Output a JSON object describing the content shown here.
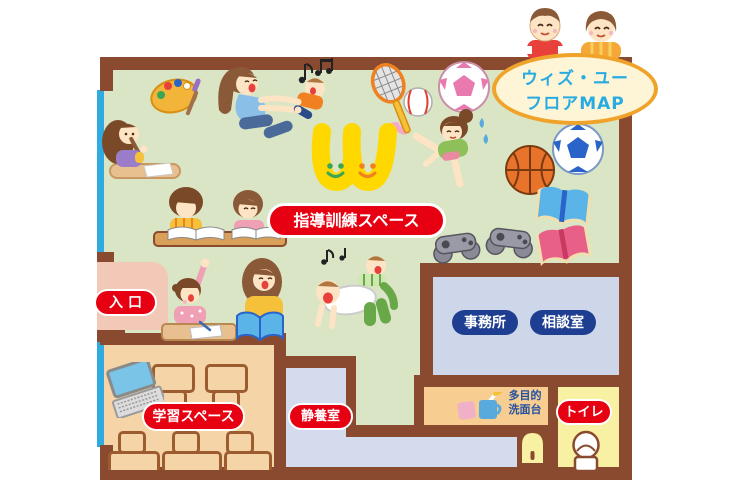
{
  "title_bubble": {
    "line1": "ウィズ・ユー",
    "line2": "フロアMAP"
  },
  "labels": {
    "training_space": "指導訓練スペース",
    "entrance": "入口",
    "learning_space": "学習スペース",
    "rest_room": "静養室",
    "office": "事務所",
    "consultation": "相談室",
    "washstand": {
      "line1": "多目的",
      "line2": "洗面台"
    },
    "toilet": "トイレ"
  },
  "colors": {
    "wall_brown": "#8a4a2f",
    "main_floor_green": "#d9e5c4",
    "entrance_pink": "#f2c8b6",
    "learning_tan": "#f5d5a8",
    "rest_lavender": "#d4dbec",
    "office_blue": "#cdd7e9",
    "washstand_orange": "#f7cd92",
    "toilet_yellow": "#f8f0a2",
    "window_cyan": "#2fabe1",
    "label_red": "#e60012",
    "label_navy": "#1e3e92",
    "title_text_blue": "#29abe2",
    "title_border_orange": "#f0a32a",
    "logo_yellow": "#ffd800"
  },
  "illustrations": [
    "peeking-kids-illustration",
    "paint-palette-icon",
    "recorder-girl-illustration",
    "mother-baby-illustration",
    "w-smile-logo",
    "badminton-racket-icon",
    "baseball-icon",
    "soccer-ball-pink-icon",
    "exercise-girl-illustration",
    "basketball-icon",
    "soccer-ball-blue-icon",
    "studying-kids-illustration",
    "game-controller-icon",
    "open-book-blue-icon",
    "open-book-pink-icon",
    "hand-raising-girl-teacher-illustration",
    "playing-boys-illustration",
    "laptop-icon",
    "desk",
    "chair",
    "cups-icon",
    "arch-door",
    "toilet-icon"
  ]
}
